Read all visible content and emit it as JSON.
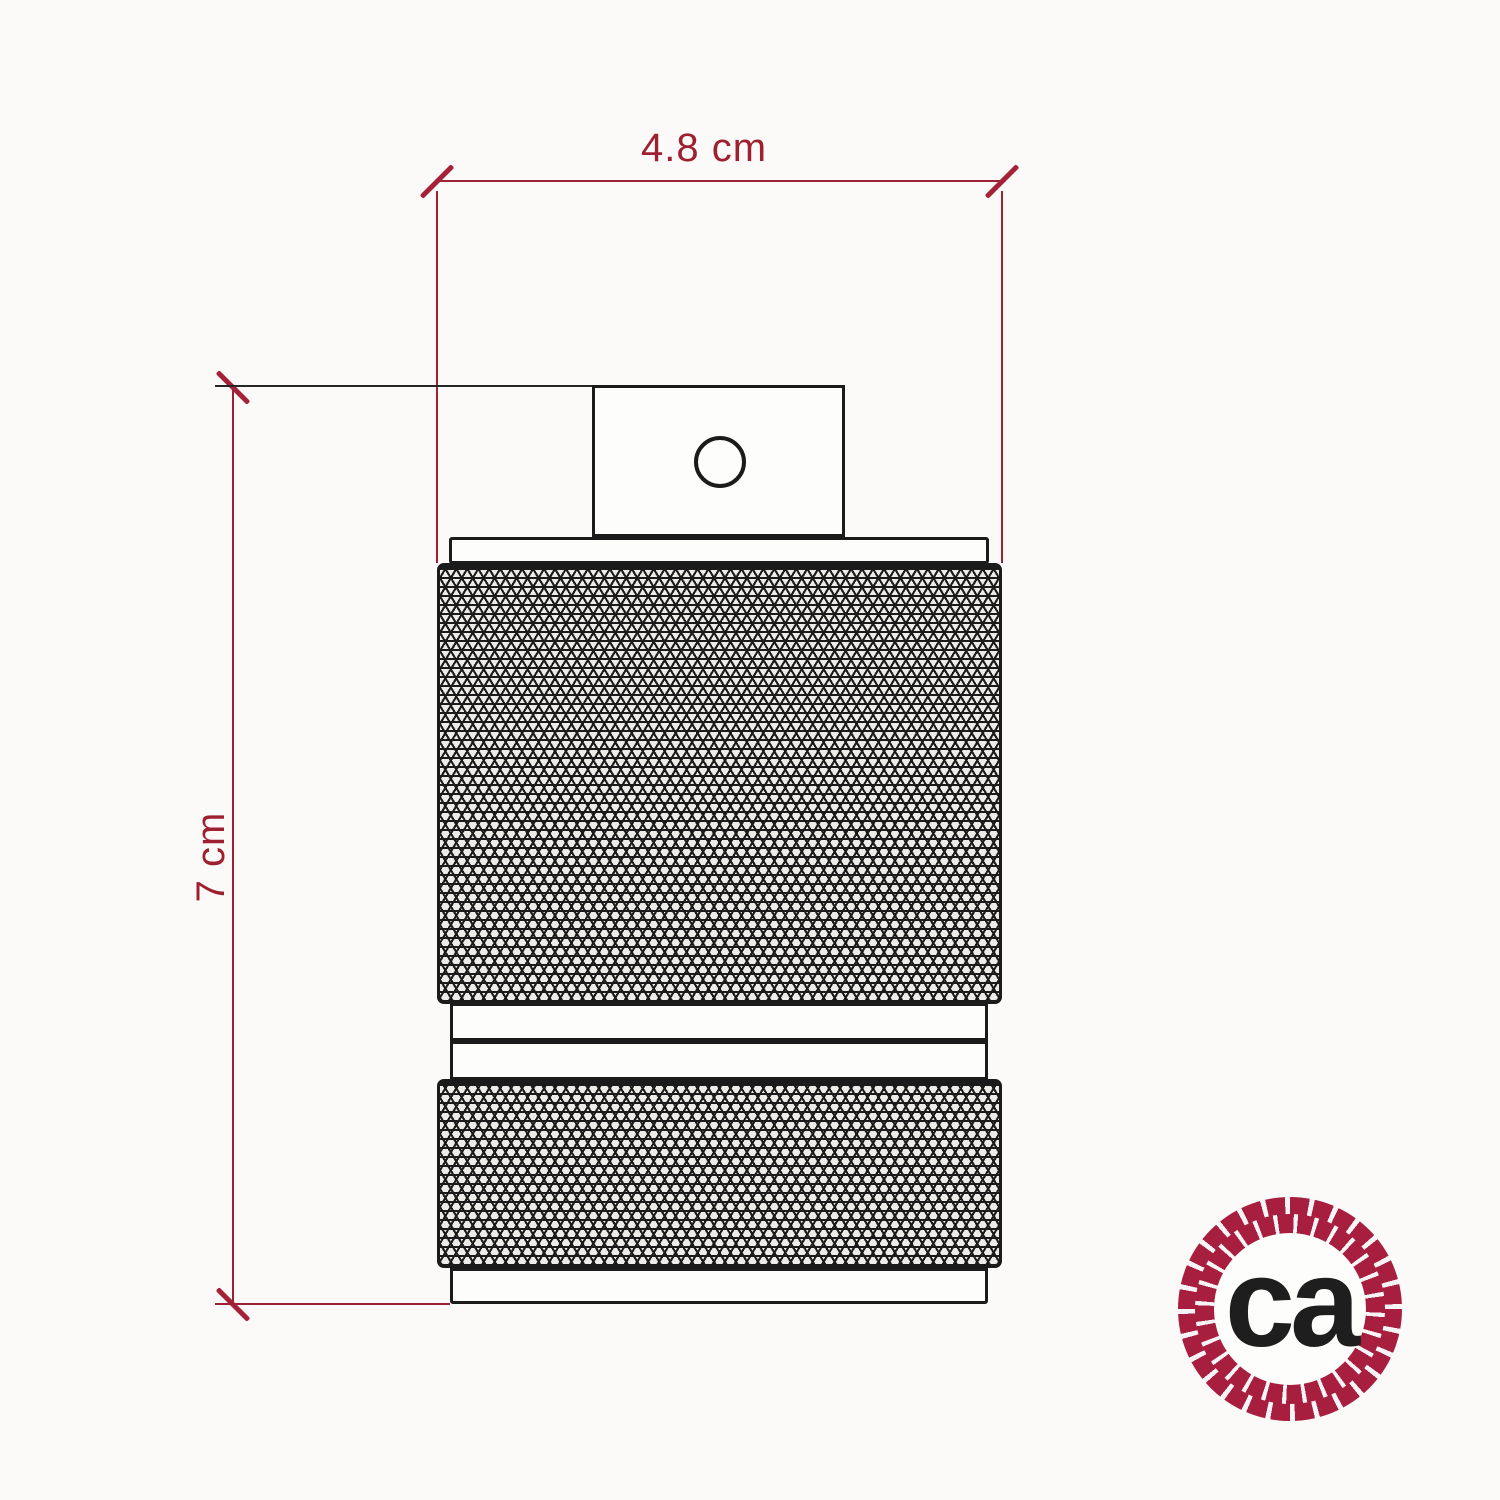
{
  "page": {
    "background": "#fbfaf9"
  },
  "dimensions": {
    "width": {
      "label": "4.8 cm"
    },
    "height": {
      "label": "7 cm"
    },
    "line_color": "#9c2133",
    "tick_color": "#a42138",
    "label_color": "#9e2030"
  },
  "product": {
    "line_color": "#1b1b1b"
  },
  "logo": {
    "text": "ca",
    "rope_color": "#a81e3e",
    "text_color": "#1e1e1e"
  }
}
